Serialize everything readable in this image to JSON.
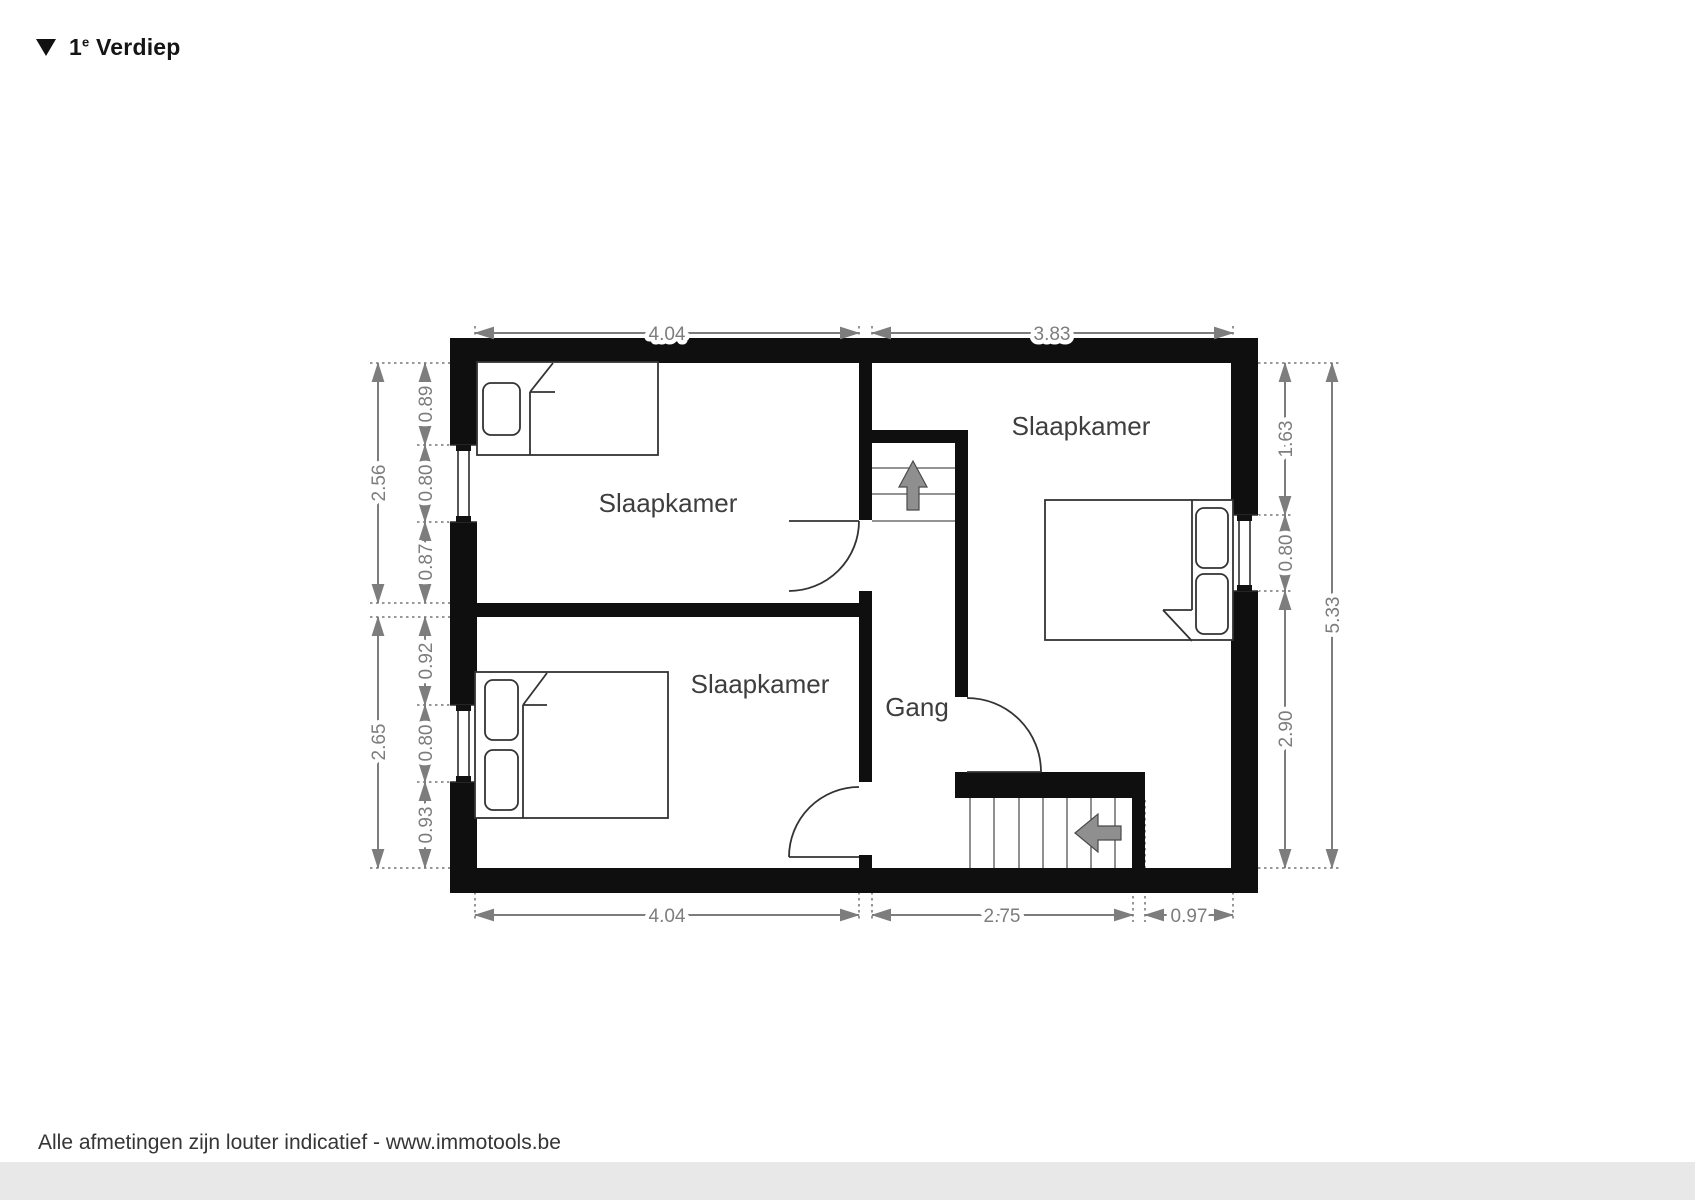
{
  "title": {
    "number": "1",
    "superscript": "e",
    "word": "Verdiep"
  },
  "rooms": {
    "bedroom_top_left": "Slaapkamer",
    "bedroom_bottom_left": "Slaapkamer",
    "bedroom_right": "Slaapkamer",
    "hallway": "Gang"
  },
  "dimensions": {
    "top": [
      "4.04",
      "3.83"
    ],
    "bottom": [
      "4.04",
      "2.75",
      "0.97"
    ],
    "left_outer": [
      "2.56",
      "2.65"
    ],
    "left_inner": [
      "0.89",
      "0.80",
      "0.87",
      "0.92",
      "0.80",
      "0.93"
    ],
    "right_inner": [
      "1.63",
      "0.80",
      "2.90"
    ],
    "right_outer": [
      "5.33"
    ]
  },
  "footer": {
    "disclaimer": "Alle afmetingen zijn louter indicatief - www.immotools.be"
  },
  "icons": {
    "floor_marker": "down-triangle",
    "stairs_up_arrow": "arrow-up",
    "stairs_down_arrow": "arrow-left"
  },
  "colors": {
    "wall": "#0f0f0f",
    "dim": "#7d7d7d",
    "label": "#3e3e3e",
    "line": "#333333",
    "arrow": "#8f8f8f",
    "footer-band": "#e8e8e8",
    "text": "#1c1c1c"
  }
}
